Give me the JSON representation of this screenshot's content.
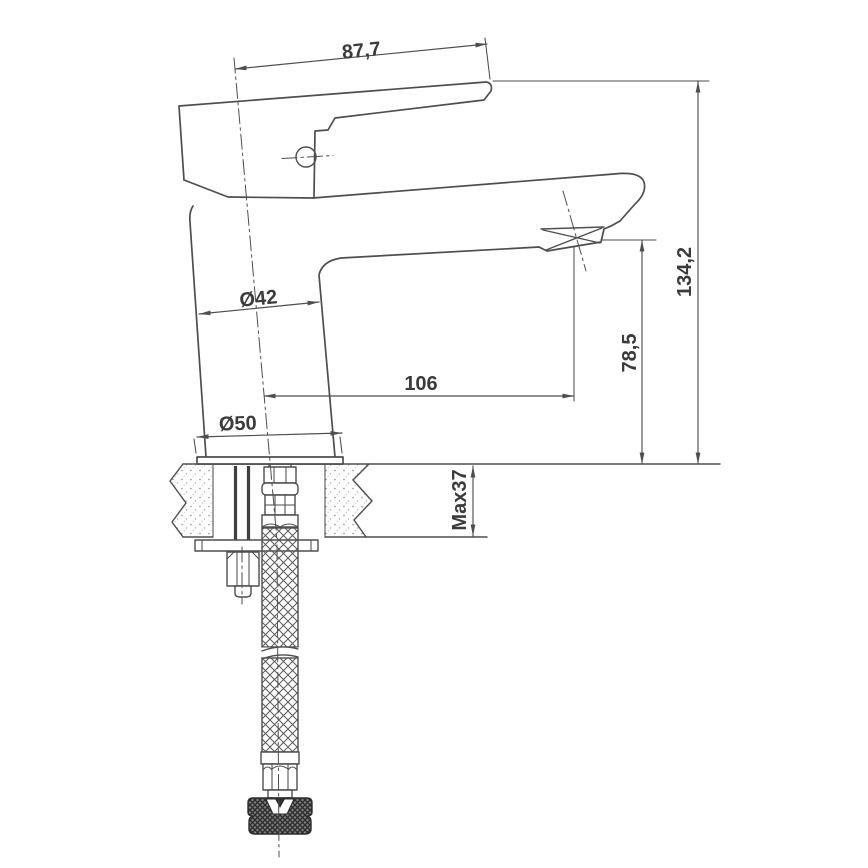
{
  "diagram": {
    "type": "technical-dimension-drawing",
    "subject": "single-lever basin mixer faucet, side view with countertop installation cross-section and flexible supply hose",
    "colors": {
      "line": "#4e4e4e",
      "text": "#3b3b3b",
      "background": "#ffffff"
    },
    "dims": {
      "handle_length": "87,7",
      "body_diameter": "Ø42",
      "base_diameter": "Ø50",
      "spout_reach": "106",
      "spout_height": "78,5",
      "total_height": "134,2",
      "counter_thickness": "Max37"
    }
  }
}
